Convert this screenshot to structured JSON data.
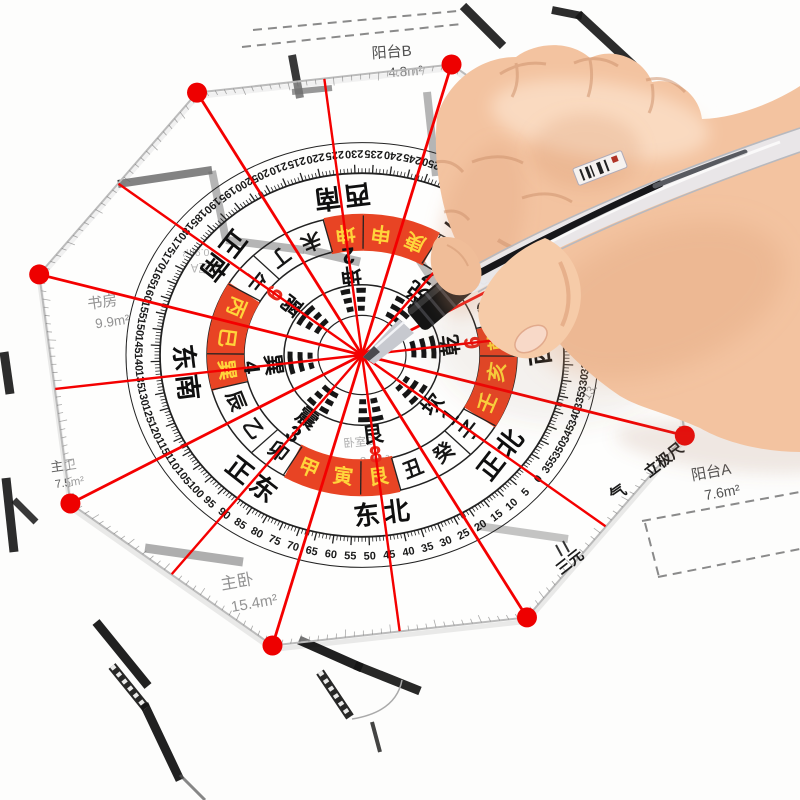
{
  "compass": {
    "brand": {
      "line1": "三元",
      "line2": "立极尺",
      "qi": "气"
    },
    "directions": [
      {
        "deg": 0,
        "label": "正北"
      },
      {
        "deg": 45,
        "label": "东北"
      },
      {
        "deg": 90,
        "label": "正东"
      },
      {
        "deg": 135,
        "label": "东南"
      },
      {
        "deg": 180,
        "label": "正南"
      },
      {
        "deg": 225,
        "label": "西南"
      },
      {
        "deg": 270,
        "label": "正西"
      },
      {
        "deg": 315,
        "label": "西北"
      }
    ],
    "mountains": [
      {
        "deg": 0,
        "label": "子",
        "red": false
      },
      {
        "deg": 15,
        "label": "癸",
        "red": false
      },
      {
        "deg": 30,
        "label": "丑",
        "red": false
      },
      {
        "deg": 45,
        "label": "艮",
        "red": true
      },
      {
        "deg": 60,
        "label": "寅",
        "red": true
      },
      {
        "deg": 75,
        "label": "甲",
        "red": true
      },
      {
        "deg": 90,
        "label": "卯",
        "red": false
      },
      {
        "deg": 105,
        "label": "乙",
        "red": false
      },
      {
        "deg": 120,
        "label": "辰",
        "red": false
      },
      {
        "deg": 135,
        "label": "巽",
        "red": true
      },
      {
        "deg": 150,
        "label": "巳",
        "red": true
      },
      {
        "deg": 165,
        "label": "丙",
        "red": true
      },
      {
        "deg": 180,
        "label": "午",
        "red": false
      },
      {
        "deg": 195,
        "label": "丁",
        "red": false
      },
      {
        "deg": 210,
        "label": "未",
        "red": false
      },
      {
        "deg": 225,
        "label": "坤",
        "red": true
      },
      {
        "deg": 240,
        "label": "申",
        "red": true
      },
      {
        "deg": 255,
        "label": "庚",
        "red": true
      },
      {
        "deg": 270,
        "label": "酉",
        "red": false
      },
      {
        "deg": 285,
        "label": "辛",
        "red": false
      },
      {
        "deg": 300,
        "label": "戌",
        "red": false
      },
      {
        "deg": 315,
        "label": "乾",
        "red": true
      },
      {
        "deg": 330,
        "label": "亥",
        "red": true
      },
      {
        "deg": 345,
        "label": "壬",
        "red": true
      }
    ],
    "trigrams": [
      {
        "deg": 0,
        "name": "坎",
        "num": "1",
        "red": false,
        "lines": [
          0,
          1,
          0
        ]
      },
      {
        "deg": 45,
        "name": "艮",
        "num": "8",
        "red": true,
        "lines": [
          1,
          0,
          0
        ]
      },
      {
        "deg": 90,
        "name": "震",
        "num": "3",
        "red": false,
        "lines": [
          0,
          0,
          1
        ]
      },
      {
        "deg": 135,
        "name": "巽",
        "num": "4",
        "red": false,
        "lines": [
          1,
          1,
          0
        ]
      },
      {
        "deg": 180,
        "name": "离",
        "num": "9",
        "red": true,
        "lines": [
          1,
          0,
          1
        ]
      },
      {
        "deg": 225,
        "name": "坤",
        "num": "2",
        "red": false,
        "lines": [
          0,
          0,
          0
        ]
      },
      {
        "deg": 270,
        "name": "兑",
        "num": "7",
        "red": false,
        "lines": [
          0,
          1,
          1
        ]
      },
      {
        "deg": 315,
        "name": "乾",
        "num": "6",
        "red": true,
        "lines": [
          1,
          1,
          1
        ]
      }
    ],
    "degree_ring": {
      "start": 0,
      "step": 5,
      "count": 72
    },
    "colors": {
      "red_cell": "#e84424",
      "cell_text_yellow": "#ffd43b",
      "line_red": "#f40000",
      "dot_red": "#ee0000",
      "num_red": "#e8291c",
      "ink_black": "#161616"
    }
  },
  "floorplan": {
    "rooms": [
      {
        "id": "yangtai-b",
        "name": "阳台B",
        "area": "4.8m²"
      },
      {
        "id": "shufang",
        "name": "书房",
        "area": "9.9m²"
      },
      {
        "id": "zhuwei",
        "name": "主卫",
        "area": "7.5m²"
      },
      {
        "id": "zhuwo",
        "name": "主卧",
        "area": "15.4m²"
      },
      {
        "id": "woshi-b",
        "name": "卧室B",
        "area": "8.0m²"
      },
      {
        "id": "woshi-a",
        "name": "卧室A",
        "area": "0.9m²"
      },
      {
        "id": "yangtai-a",
        "name": "阳台A",
        "area": "7.6m²"
      },
      {
        "id": "room-partial",
        "name": "",
        "area": "13."
      }
    ]
  }
}
